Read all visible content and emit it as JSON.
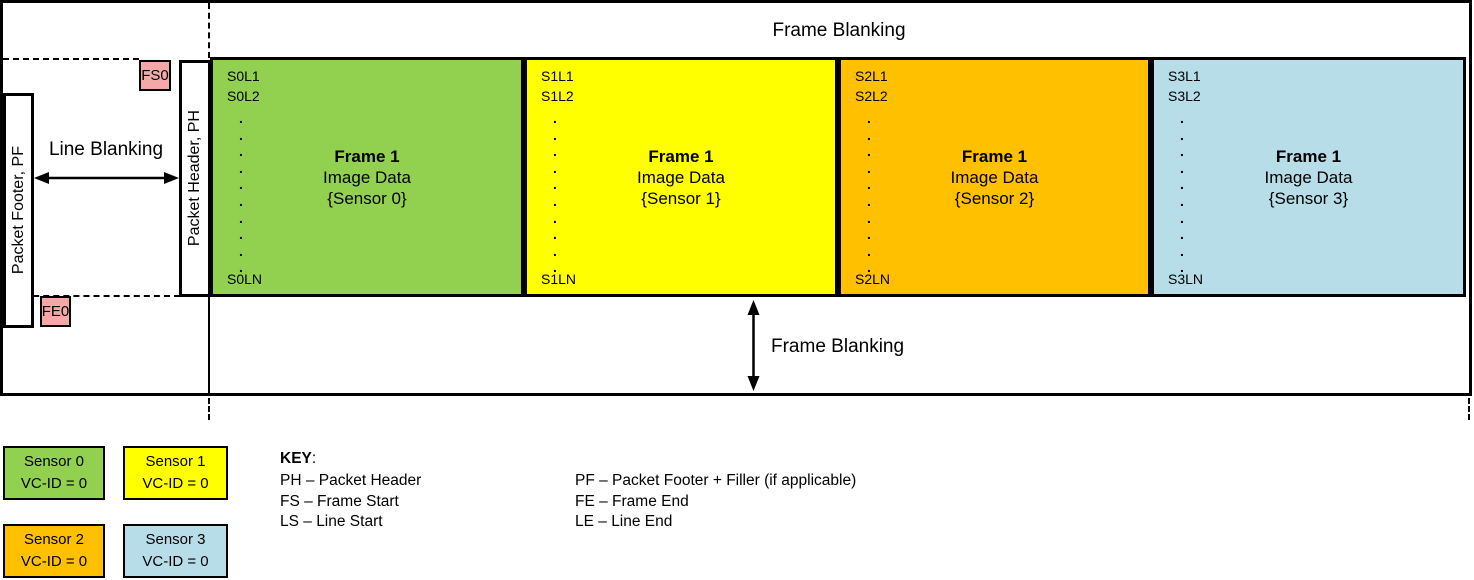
{
  "diagram": {
    "top_band_label": "Frame Blanking",
    "bottom_band_label": "Frame Blanking",
    "line_blanking_label": "Line Blanking",
    "packet_footer_label": "Packet Footer, PF",
    "packet_header_label": "Packet Header, PH",
    "frame_start_marker": "FS0",
    "frame_end_marker": "FE0",
    "frames": [
      {
        "first_line": "S0L1",
        "second_line": "S0L2",
        "dots": ".\n.\n.\n.\n.\n.\n.\n.\n.\n.",
        "last_line": "S0LN",
        "title": "Frame 1",
        "subtitle": "Image Data",
        "caption": "{Sensor 0}",
        "color": "#92D050"
      },
      {
        "first_line": "S1L1",
        "second_line": "S1L2",
        "dots": ".\n.\n.\n.\n.\n.\n.\n.\n.\n.",
        "last_line": "S1LN",
        "title": "Frame 1",
        "subtitle": "Image Data",
        "caption": "{Sensor 1}",
        "color": "#FFFF00"
      },
      {
        "first_line": "S2L1",
        "second_line": "S2L2",
        "dots": ".\n.\n.\n.\n.\n.\n.\n.\n.\n.",
        "last_line": "S2LN",
        "title": "Frame 1",
        "subtitle": "Image Data",
        "caption": "{Sensor 2}",
        "color": "#FFC000"
      },
      {
        "first_line": "S3L1",
        "second_line": "S3L2",
        "dots": ".\n.\n.\n.\n.\n.\n.\n.\n.\n.",
        "last_line": "S3LN",
        "title": "Frame 1",
        "subtitle": "Image Data",
        "caption": "{Sensor 3}",
        "color": "#B7DDE8"
      }
    ],
    "marker_color": "#F5A8A8"
  },
  "legend": {
    "items": [
      {
        "label": "Sensor 0",
        "vc": "VC-ID = 0",
        "color": "#92D050"
      },
      {
        "label": "Sensor 1",
        "vc": "VC-ID = 0",
        "color": "#FFFF00"
      },
      {
        "label": "Sensor 2",
        "vc": "VC-ID = 0",
        "color": "#FFC000"
      },
      {
        "label": "Sensor 3",
        "vc": "VC-ID = 0",
        "color": "#B7DDE8"
      }
    ]
  },
  "key": {
    "heading": "KEY",
    "heading_colon": ":",
    "col1": [
      "PH – Packet Header",
      "FS – Frame Start",
      "LS – Line Start"
    ],
    "col2": [
      "PF – Packet Footer + Filler (if applicable)",
      "FE – Frame End",
      "LE – Line End"
    ]
  }
}
